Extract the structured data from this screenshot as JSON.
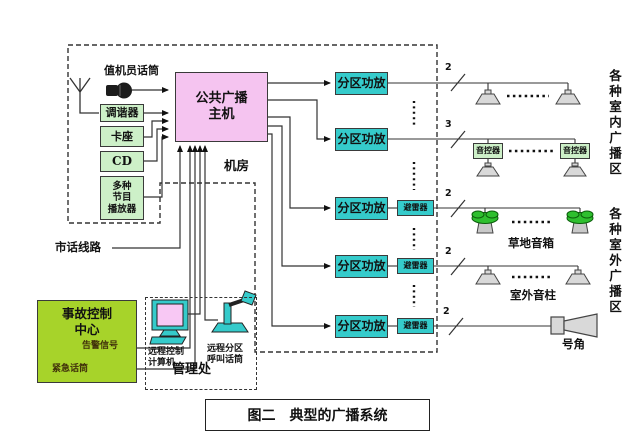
{
  "figure": {
    "caption": "图二　典型的广播系统"
  },
  "room_label": "机房",
  "sources": {
    "operator_mic": "值机员话筒",
    "tuner": "调谐器",
    "tape_deck": "卡座",
    "cd": "CD",
    "multi_player": "多种\n节目\n播放器"
  },
  "main_unit": {
    "label": "公共广播\n主机"
  },
  "amps": [
    "分区功放",
    "分区功放",
    "分区功放",
    "分区功放",
    "分区功放"
  ],
  "arresters": [
    "避雷器",
    "避雷器",
    "避雷器"
  ],
  "volume_controllers": [
    "音控器",
    "音控器"
  ],
  "wire_counts": [
    "2",
    "3",
    "2",
    "2",
    "2"
  ],
  "zones": {
    "indoor": "各种室内广播区",
    "outdoor": "各种室外广播区"
  },
  "speakers": {
    "lawn": "草地音箱",
    "column": "室外音柱",
    "horn": "号角"
  },
  "telephone": {
    "label": "市话线路"
  },
  "accident_center": {
    "title": "事故控制\n中心",
    "alarm": "告警信号",
    "emergency_mic": "紧急话筒"
  },
  "management": {
    "label": "管理处",
    "computer": "远程控制\n计算机",
    "call_mic": "远程分区\n呼叫话筒"
  },
  "colors": {
    "source_box": "#cdf0c8",
    "main_unit": "#f5c4f0",
    "amplifier": "#35cbcb",
    "accident_center": "#a7d32a",
    "lawn_green": "#2ebf2e",
    "wire": "#333333"
  }
}
